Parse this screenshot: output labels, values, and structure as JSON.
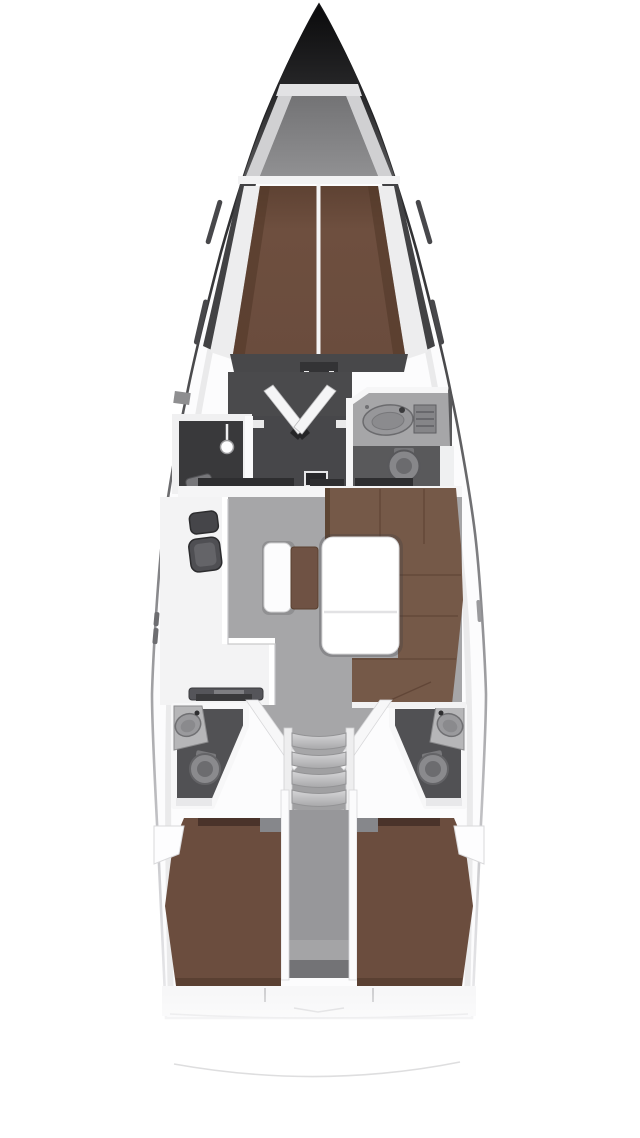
{
  "page": {
    "title": "Sailing yacht interior floor plan — top view, bow up"
  },
  "diagram": {
    "type": "floor-plan",
    "subject": "sailing yacht interior, top-down view",
    "orientation": "bow-up",
    "areas": [
      {
        "id": "bow-anchor-locker",
        "name": "Bow and anchor locker"
      },
      {
        "id": "forward-cabin",
        "name": "Forward cabin with V-berth"
      },
      {
        "id": "wardrobe",
        "name": "Wardrobe with folding V-doors"
      },
      {
        "id": "forward-shower",
        "name": "Forward separate shower stall"
      },
      {
        "id": "forward-bathroom",
        "name": "Forward bathroom with sink and toilet"
      },
      {
        "id": "galley",
        "name": "L-shaped galley with double sink and stove"
      },
      {
        "id": "salon",
        "name": "Salon with L-shaped settee and table"
      },
      {
        "id": "center-seat",
        "name": "Center bench seat"
      },
      {
        "id": "companionway",
        "name": "Companionway stairs"
      },
      {
        "id": "aft-bathroom-port",
        "name": "Aft bathroom port side with corner sink and toilet"
      },
      {
        "id": "aft-bathroom-starboard",
        "name": "Aft bathroom starboard side with corner sink and toilet"
      },
      {
        "id": "aft-cabin-port",
        "name": "Aft cabin port with double berth"
      },
      {
        "id": "aft-cabin-starboard",
        "name": "Aft cabin starboard with double berth"
      },
      {
        "id": "stern",
        "name": "Stern deck fading out"
      }
    ],
    "fixtures": [
      "v-berth",
      "folding-doors",
      "shower-head",
      "oval-sink",
      "round-toilet",
      "double-galley-sink",
      "stove",
      "salon-table",
      "stair-treads",
      "double-berths"
    ],
    "colors": {
      "background": "#ffffff",
      "hull_outline_dark": "#1d1d1f",
      "bow_cone_dark": "#121214",
      "deck_white": "#f5f5f6",
      "wall_white": "#f7f7f8",
      "floor_light_gray": "#a6a6a8",
      "floor_dark_gray": "#4a4a4c",
      "bathroom_floor": "#515154",
      "berth_brown": "#6b4d3e",
      "settee_brown": "#755948",
      "wood_dark": "#4a332a",
      "table_white": "#ffffff",
      "fixture_gray": "#8a8a8d"
    }
  }
}
